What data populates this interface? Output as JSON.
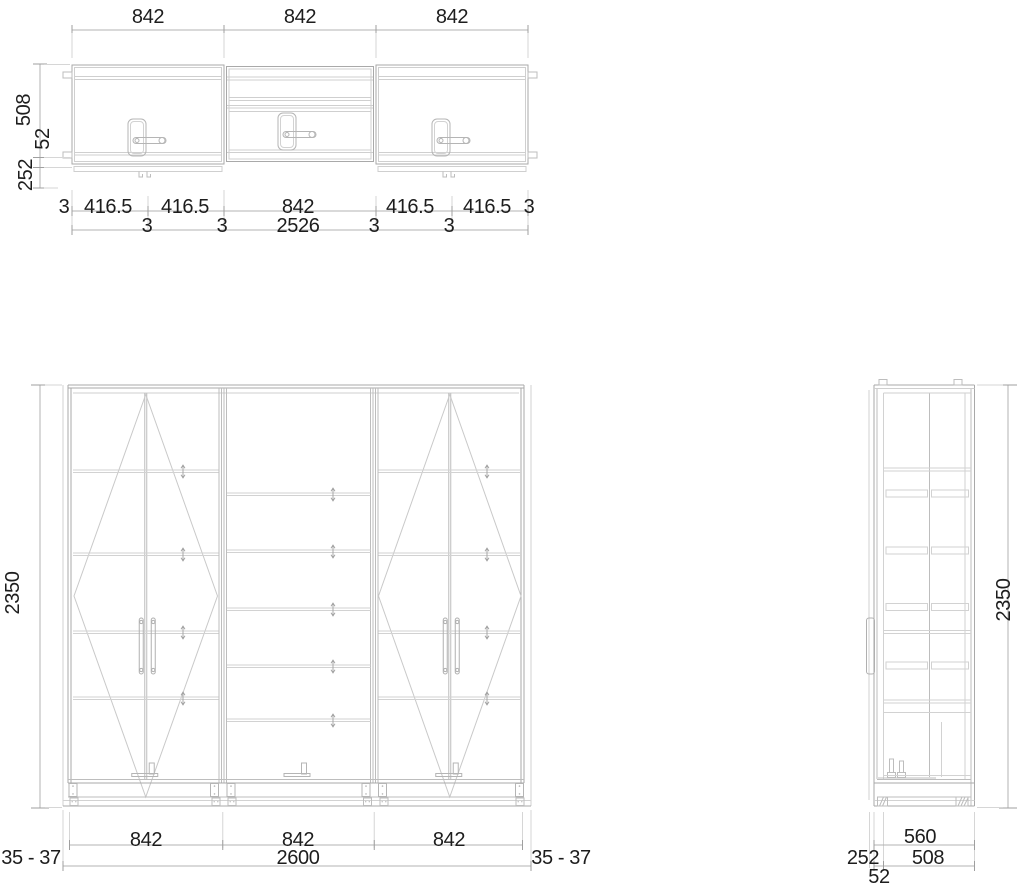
{
  "drawing": {
    "kind": "wardrobe technical drawing, plan / front / side views",
    "colors": {
      "background": "#ffffff",
      "line_main": "#a9a9a9",
      "line_light": "#cfcfcf",
      "dimension_line": "#b3b3b3",
      "text": "#1d1d1d"
    }
  },
  "plan": {
    "top_dims": [
      "842",
      "842",
      "842"
    ],
    "depth_dims": [
      "508",
      "52",
      "252"
    ],
    "bottom_row1": [
      "3",
      "416.5",
      "416.5",
      "842",
      "416.5",
      "416.5",
      "3"
    ],
    "bottom_row2": [
      "3",
      "3",
      "2526",
      "3",
      "3"
    ]
  },
  "front": {
    "height_dim": "2350",
    "section_dims": [
      "842",
      "842",
      "842"
    ],
    "total_dim": "2600",
    "gap_left": "35 - 37",
    "gap_right": "35 - 37"
  },
  "side": {
    "height_dim": "2350",
    "depth_total": "560",
    "depth_offset": "252",
    "depth_body": "508",
    "depth_door": "52"
  }
}
